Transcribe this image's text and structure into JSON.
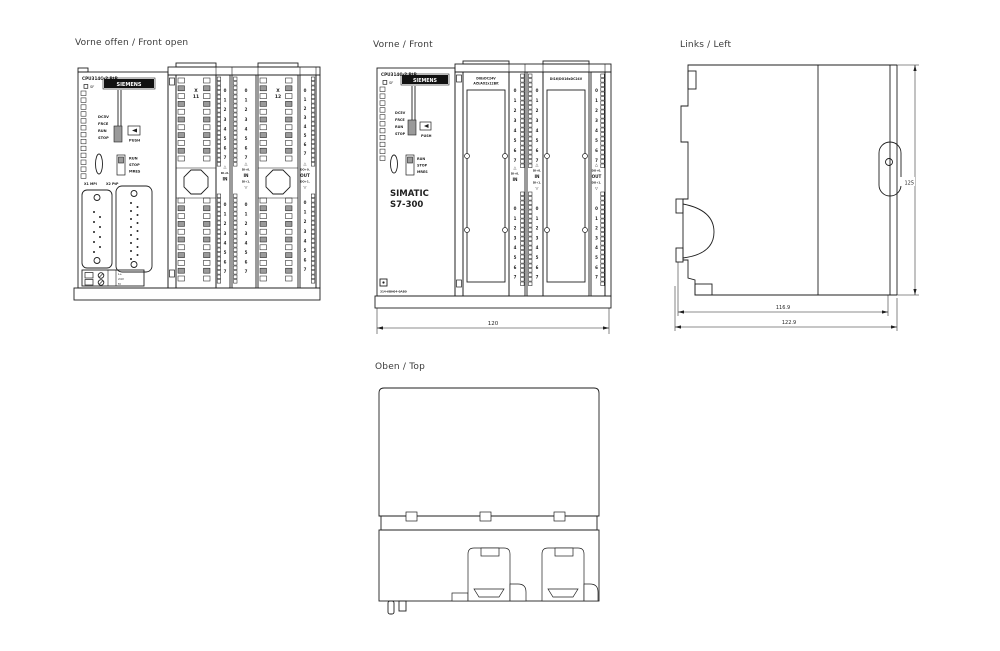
{
  "colors": {
    "line": "#1f1f1f",
    "background": "#ffffff",
    "logo_bg": "#111111"
  },
  "views": {
    "front_open": {
      "label": "Vorne offen / Front open"
    },
    "front": {
      "label": "Vorne / Front"
    },
    "left": {
      "label": "Links / Left"
    },
    "top": {
      "label": "Oben / Top"
    }
  },
  "cpu": {
    "title": "CPU314C-2 PtP",
    "sf": "SF",
    "brand": "SIEMENS",
    "leds": [
      "DC5V",
      "FRCE",
      "RUN",
      "STOP"
    ],
    "push": "PUSH",
    "mode": [
      "RUN",
      "STOP",
      "MRES"
    ],
    "ports": {
      "x1": "X1 MPI",
      "x2": "X2 PtP"
    },
    "power": [
      "L+",
      "24V",
      "M"
    ],
    "product": [
      "SIMATIC",
      "S7-300"
    ],
    "order_no": "314-6BH04-0AB0"
  },
  "io": {
    "digits": [
      "0",
      "1",
      "2",
      "3",
      "4",
      "5",
      "6",
      "7"
    ],
    "x11": [
      "X",
      "11"
    ],
    "x12": [
      "X",
      "12"
    ],
    "tri_up": "△",
    "tri_down": "▽",
    "in": "IN",
    "out": "OUT",
    "di_top": "DI+0.",
    "di_bottom": "DI+1.",
    "do_top": "DO+0.",
    "do_bottom": "DO+1.",
    "door1": [
      "DI8xDC24V",
      "AI5/AO2x12Bit"
    ],
    "door2": "DI16/DO16xDC24V"
  },
  "dims": {
    "front_width": "120",
    "left_inner": "116.9",
    "left_outer": "122.9",
    "height": "125"
  }
}
